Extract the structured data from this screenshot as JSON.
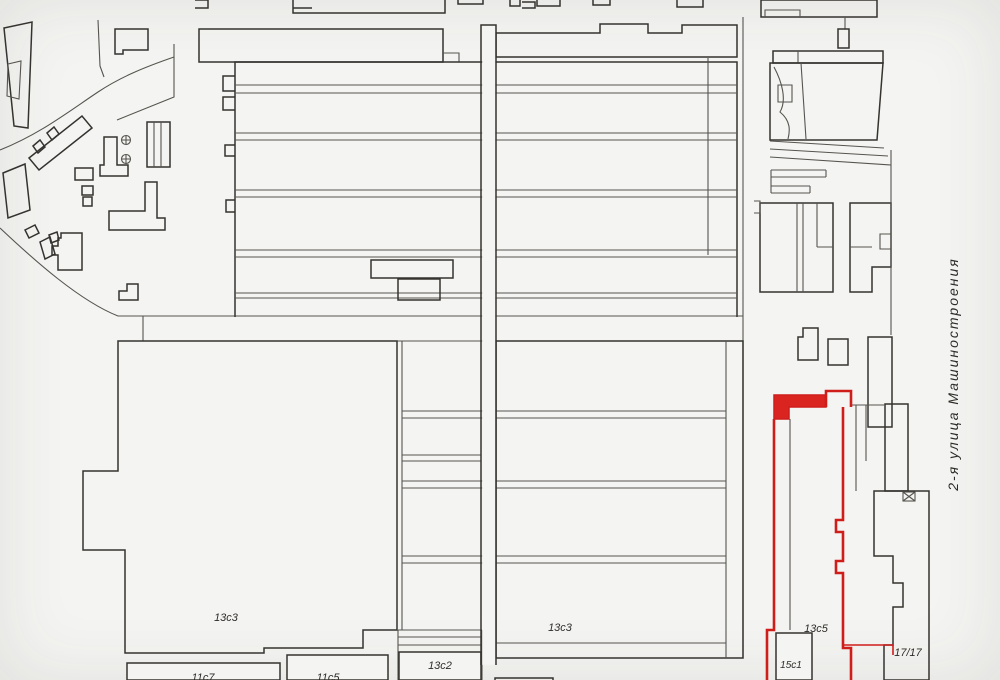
{
  "street": {
    "label": "2-я улица Машиностроения"
  },
  "labels": {
    "b13s3_west": "13с3",
    "b13s3_center": "13с3",
    "b13s2": "13с2",
    "b13s5": "13с5",
    "b15s1": "15с1",
    "b17_17": "17/17",
    "b11s7": "11с7",
    "b11s5": "11с5"
  },
  "colors": {
    "background": "#f4f4f2",
    "line": "#56544f",
    "linedark": "#35332f",
    "highlight": "#cf1d1a",
    "highlightfill": "#da2420",
    "text": "#2e2c29"
  }
}
